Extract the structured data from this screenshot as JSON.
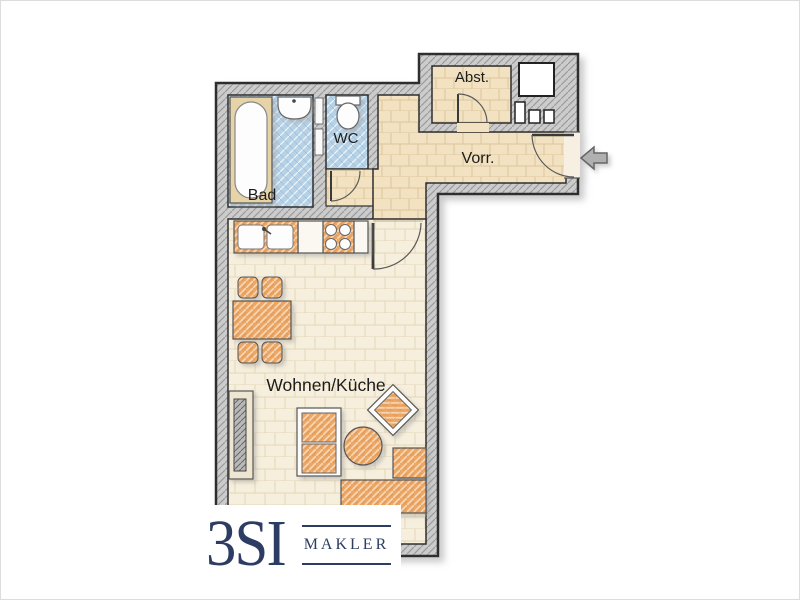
{
  "page": {
    "background": "#ffffff",
    "border_color": "#dcdcdc"
  },
  "plan": {
    "type": "apartment-floor-plan",
    "rooms": {
      "bad": {
        "label": "Bad"
      },
      "wc": {
        "label": "WC"
      },
      "abstellraum": {
        "label": "Abst."
      },
      "vorraum": {
        "label": "Vorr."
      },
      "wohnen_kueche": {
        "label": "Wohnen/Küche"
      }
    },
    "colors": {
      "wall_fill": "#cccccc",
      "wall_outline": "#2e2e2e",
      "bath_floor": "#b7d2e6",
      "hall_floor": "#f2e2c1",
      "living_floor": "#f7efdd",
      "furniture_orange": "#eca765",
      "fixture_white": "#fdfdfd",
      "arrow_gray": "#b0b0b0"
    },
    "fixtures": [
      "bathtub",
      "washbasin",
      "toilet",
      "kitchen-sink",
      "stove",
      "dining-table",
      "dining-chair",
      "radiator",
      "sofa",
      "coffee-table",
      "armchair",
      "corner-sofa",
      "shaft",
      "meter-boxes"
    ],
    "entrance": {
      "symbol": "entrance-arrow",
      "direction": "left"
    }
  },
  "logo": {
    "brand": "3SI",
    "division": "MAKLER",
    "color": "#2c3c63"
  }
}
